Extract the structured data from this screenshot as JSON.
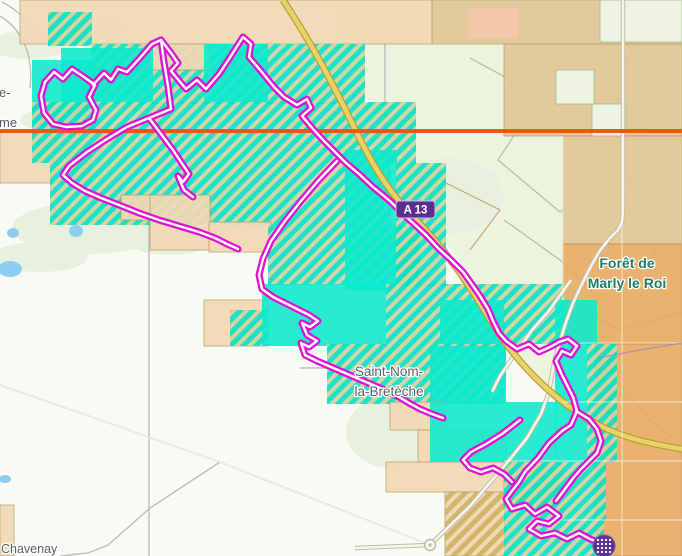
{
  "window": {
    "width": 682,
    "height": 556,
    "title": "Map view with explorer tiles and activity route"
  },
  "map": {
    "labels": [
      {
        "id": "forest-name",
        "lines": [
          "Forêt de",
          "Marly le Roi"
        ],
        "x": 627,
        "y": 268,
        "color": "#1e7d63",
        "size": 14,
        "weight": "bold",
        "anchor": "middle",
        "lineh": 20
      },
      {
        "id": "town-name",
        "lines": [
          "Saint-Nom-",
          "la-Bretèche"
        ],
        "x": 389,
        "y": 376,
        "color": "#5b5f66",
        "size": 13.5,
        "weight": "normal",
        "anchor": "middle",
        "lineh": 20
      },
      {
        "id": "town-bottom-left",
        "lines": [
          "Chavenay"
        ],
        "x": 1,
        "y": 553,
        "color": "#5b5f66",
        "size": 12.5,
        "weight": "normal",
        "anchor": "start",
        "lineh": 15
      },
      {
        "id": "edge-left-partial-1",
        "lines": [
          "e-"
        ],
        "x": -1,
        "y": 97,
        "color": "#55595f",
        "size": 13,
        "weight": "normal",
        "anchor": "start",
        "lineh": 15
      },
      {
        "id": "edge-left-partial-2",
        "lines": [
          "me"
        ],
        "x": -1,
        "y": 127,
        "color": "#55595f",
        "size": 13,
        "weight": "normal",
        "anchor": "start",
        "lineh": 15
      }
    ],
    "road_badge": {
      "text": "A 13",
      "x": 396,
      "y": 201,
      "w": 39,
      "h": 17,
      "bg": "#5b2f91",
      "fg": "#ffffff",
      "border": "#cbbfe3"
    },
    "marker": {
      "icon": "dot-grid-icon",
      "x": 604,
      "y": 546,
      "r": 11,
      "bg": "#5b2f91",
      "ring": "#7a55ae",
      "dot": "#ffffff"
    },
    "orange_line": {
      "y": 131,
      "color": "#f2570f",
      "width": 4
    },
    "palette": {
      "base": "#f8faf4",
      "forest": "#ecf3de",
      "pale_patch": "#e7f1dd",
      "pond": "#8ecdf2",
      "tile_tan": "#f2d9b4",
      "tile_tan_forest": "#e3c693",
      "tile_orange": "#e9ab62",
      "tile_salmon": "#f6c7ad",
      "tile_gap": "#eef3e2",
      "tile_cyan": "#0ae9cd",
      "hatch_cyan": "#0ce0c4",
      "hatch_gap": "#cfd3a0",
      "hatch_gold": "#d4b264",
      "hatch_gold_gap": "#eed9b0",
      "tile_border": "#b59e66",
      "motorway_fill": "#ead269",
      "motorway_casing": "#b2a033",
      "road_white": "#f6f6ef",
      "road_casing": "#bfb9a0",
      "road_minor": "#bdbdbd",
      "forest_path": "#a9c69b",
      "forest_path_brown": "#c49a62",
      "route_color": "#de12d4",
      "route_core": "#ffffff",
      "gridline": "rgba(255,255,255,0.55)",
      "boundary_purple": "#9a8cc0"
    },
    "pale_patches": [
      [
        30,
        45,
        42,
        14
      ],
      [
        95,
        28,
        30,
        10
      ],
      [
        150,
        95,
        58,
        16
      ],
      [
        60,
        120,
        40,
        12
      ],
      [
        90,
        228,
        78,
        26
      ],
      [
        40,
        257,
        48,
        15
      ],
      [
        170,
        242,
        40,
        13
      ],
      [
        448,
        196,
        55,
        38
      ],
      [
        392,
        432,
        46,
        36
      ]
    ],
    "ponds": [
      [
        13,
        233,
        6,
        5
      ],
      [
        76,
        231,
        7,
        6
      ],
      [
        10,
        269,
        12,
        8
      ],
      [
        5,
        479,
        6,
        4
      ]
    ],
    "forest_polygon": "M310,0 L682,0 L682,450 L598,450 L560,410 L520,360 L470,280 L420,200 L370,105 L340,40 L330,0 Z",
    "tiles": [
      [
        20,
        0,
        412,
        44,
        "T"
      ],
      [
        432,
        0,
        250,
        44,
        "T2"
      ],
      [
        600,
        0,
        82,
        42,
        "G"
      ],
      [
        468,
        8,
        50,
        30,
        "S"
      ],
      [
        48,
        12,
        44,
        34,
        "H"
      ],
      [
        504,
        44,
        178,
        92,
        "T2"
      ],
      [
        556,
        70,
        38,
        34,
        "G"
      ],
      [
        592,
        104,
        34,
        40,
        "G"
      ],
      [
        563,
        136,
        119,
        108,
        "T2"
      ],
      [
        563,
        244,
        119,
        100,
        "O"
      ],
      [
        595,
        344,
        87,
        212,
        "O"
      ],
      [
        0,
        131,
        91,
        52,
        "T"
      ],
      [
        91,
        44,
        274,
        60,
        "H"
      ],
      [
        150,
        44,
        60,
        26,
        "T"
      ],
      [
        204,
        44,
        64,
        60,
        "C"
      ],
      [
        61,
        48,
        92,
        54,
        "C"
      ],
      [
        32,
        60,
        64,
        74,
        "C"
      ],
      [
        32,
        102,
        384,
        61,
        "H"
      ],
      [
        50,
        163,
        341,
        62,
        "H"
      ],
      [
        121,
        195,
        30,
        25,
        "T"
      ],
      [
        150,
        195,
        60,
        55,
        "T"
      ],
      [
        209,
        222,
        62,
        30,
        "T"
      ],
      [
        268,
        225,
        152,
        60,
        "H"
      ],
      [
        345,
        150,
        52,
        140,
        "C"
      ],
      [
        396,
        163,
        50,
        123,
        "H"
      ],
      [
        204,
        300,
        64,
        46,
        "T"
      ],
      [
        230,
        310,
        38,
        36,
        "H"
      ],
      [
        262,
        284,
        124,
        62,
        "C"
      ],
      [
        386,
        284,
        118,
        60,
        "H"
      ],
      [
        440,
        300,
        66,
        62,
        "C"
      ],
      [
        504,
        284,
        60,
        60,
        "H"
      ],
      [
        555,
        300,
        42,
        44,
        "C"
      ],
      [
        327,
        344,
        178,
        60,
        "H"
      ],
      [
        430,
        346,
        76,
        58,
        "C"
      ],
      [
        555,
        344,
        32,
        118,
        "C"
      ],
      [
        587,
        344,
        30,
        118,
        "H"
      ],
      [
        390,
        402,
        56,
        28,
        "T"
      ],
      [
        418,
        430,
        88,
        32,
        "T"
      ],
      [
        386,
        462,
        120,
        30,
        "T"
      ],
      [
        430,
        402,
        126,
        60,
        "C"
      ],
      [
        445,
        492,
        60,
        64,
        "TH"
      ],
      [
        504,
        462,
        60,
        48,
        "TH"
      ],
      [
        504,
        462,
        102,
        58,
        "H"
      ],
      [
        504,
        520,
        100,
        36,
        "H"
      ],
      [
        0,
        505,
        14,
        51,
        "T"
      ]
    ],
    "roads": {
      "minor": [
        "M0,385 L220,462 L430,545",
        "M220,462 L150,508 108,545 88,553 60,556",
        "M149,224 L149,556",
        "M385,0 L385,163",
        "M300,368 L458,368",
        "M380,340 L383,368",
        "M420,388 L442,412 436,440 418,462",
        "M0,16 C20,28 34,52 30,88",
        "M2,2 C18,10 30,22 38,40"
      ],
      "forest_paths": [
        "M470,58 L540,96 498,160 560,212 622,168 660,232 640,300",
        "M622,0 L640,40 610,90 648,140",
        "M504,220 L560,260 600,300 570,340"
      ],
      "brown_paths": [
        "M563,300 L620,330 682,312",
        "M600,362 L650,420 678,442",
        "M440,180 L500,210 470,250"
      ],
      "major_white": [
        "M355,548 L430,545 470,506 506,464 527,438 541,414 549,392 553,368 558,348 565,325 573,303 581,286 590,268 599,252 609,239 618,230 622,222 623,210 623,0",
        "M571,280 L548,312 532,330 523,343 511,360 500,376 492,392"
      ],
      "motorway": "M283,0 C312,44 332,82 356,131 C377,174 392,196 420,224 C447,252 468,283 491,321 C512,356 543,390 580,414 C613,436 645,443 682,449",
      "roundabout": {
        "x": 430,
        "y": 545,
        "r": 5.5
      },
      "gridlines": [
        "M622,136 L622,556",
        "M563,136 L563,300",
        "M563,343 L682,343",
        "M563,402 L682,402",
        "M504,461 L682,461",
        "M563,520 L682,520"
      ],
      "boundary": "M598,358 L640,350 682,343"
    },
    "route": {
      "paths": [
        "M84,77 L72,69 63,79 54,72 45,82 41,96 44,113 53,124 66,127 82,126 93,120 96,110 89,97 95,85 Z",
        "M93,85 L104,73 111,80 118,69 127,72 139,59 152,44 161,40 171,53 178,63 171,71 186,89 197,80 206,89 219,74 229,59 243,37 251,44 249,57 261,71 274,87 284,97 297,105 307,99 311,108 302,116 313,129 324,141 336,153 346,163 359,174 373,187 390,201 400,211 413,223 426,235 438,248 451,260 463,272 471,283 480,296 488,309 493,321 499,333 506,341 517,349 529,344 539,352 550,347 559,342 568,339 577,346 571,355 562,351 556,361 561,373 567,385 573,397 577,411 571,425 562,431 549,443 538,458 525,472 519,482 512,491 506,499 512,509 525,505 535,514 547,507 559,516 549,524 537,521 529,529 541,536 555,533 567,539 579,533 590,539 600,543 604,546",
        "M161,40 L164,62 168,86 171,109",
        "M171,109 L149,118 127,127 107,139 87,152 69,166 63,175 72,183 85,191 101,198 119,205 139,213 159,220 179,226 199,232 215,238 227,244 238,249",
        "M337,161 L318,181 301,201 285,221 271,241 263,259 259,275 262,289 273,297 285,303 297,309 309,315 318,321 310,327 302,323 307,335 317,341 309,347 301,343 305,355 317,361 331,367 345,373 359,379 373,385 387,391 399,397 409,403 420,409 432,414 443,418",
        "M149,118 L161,134 173,150 181,162 189,174 183,182 178,176 184,190 193,197",
        "M520,420 L502,434 486,444 471,452 463,460 470,468 481,472 493,468 504,474 512,482",
        "M576,411 L589,419 597,429 601,441 597,453 589,461 581,469 574,477 568,485 562,493 556,501"
      ]
    }
  }
}
